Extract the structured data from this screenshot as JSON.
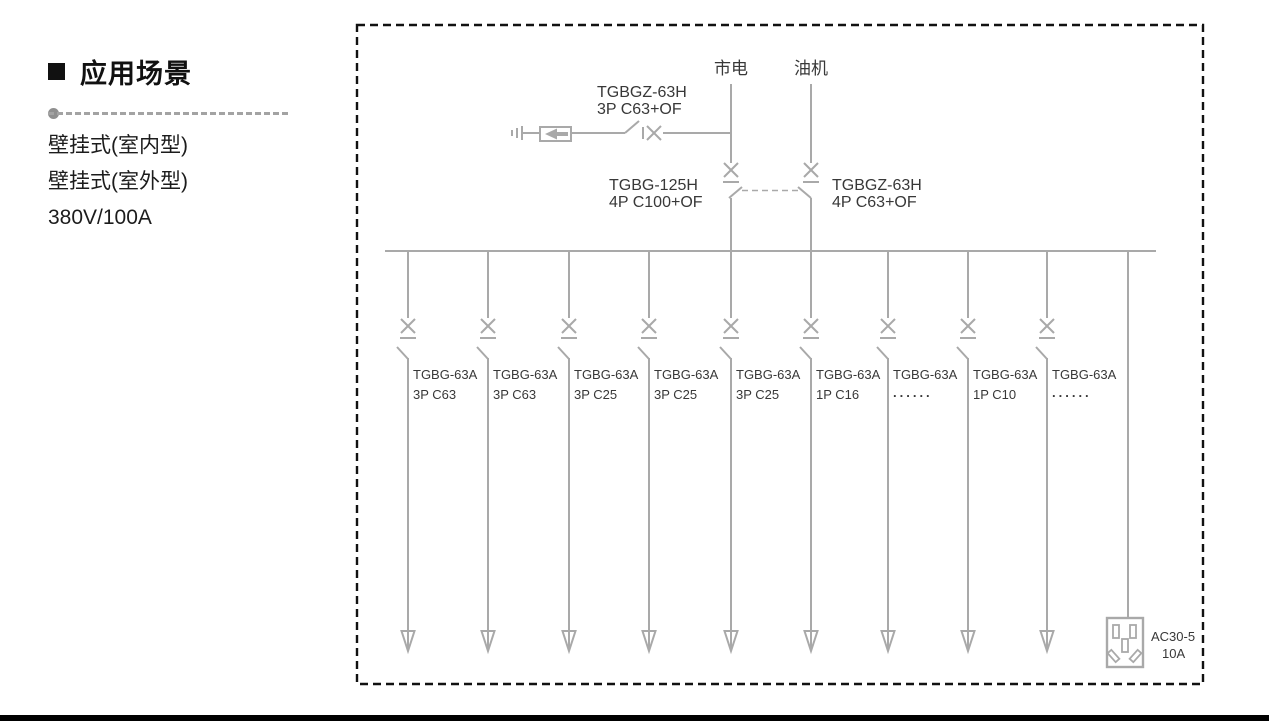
{
  "left_panel": {
    "heading": "应用场景",
    "items": [
      "壁挂式(室内型)",
      "壁挂式(室外型)",
      "380V/100A"
    ]
  },
  "diagram": {
    "sources": {
      "mains": "市电",
      "generator": "油机"
    },
    "spd_breaker": {
      "model": "TGBGZ-63H",
      "spec": "3P C63+OF"
    },
    "main_breaker": {
      "model": "TGBG-125H",
      "spec": "4P C100+OF"
    },
    "gen_breaker": {
      "model": "TGBGZ-63H",
      "spec": "4P C63+OF"
    },
    "branches": [
      {
        "model": "TGBG-63A",
        "spec": "3P C63"
      },
      {
        "model": "TGBG-63A",
        "spec": "3P C63"
      },
      {
        "model": "TGBG-63A",
        "spec": "3P C25"
      },
      {
        "model": "TGBG-63A",
        "spec": "3P C25"
      },
      {
        "model": "TGBG-63A",
        "spec": "3P C25"
      },
      {
        "model": "TGBG-63A",
        "spec": "1P C16"
      },
      {
        "model": "TGBG-63A",
        "spec": "......"
      },
      {
        "model": "TGBG-63A",
        "spec": "1P C10"
      },
      {
        "model": "TGBG-63A",
        "spec": "......"
      }
    ],
    "socket": {
      "model": "AC30-5",
      "rating": "10A"
    }
  },
  "colors": {
    "diagram_line": "#a9a9a9",
    "diagram_text": "#383838",
    "border_dash": "#111111",
    "bottom_bar": "#000000"
  }
}
